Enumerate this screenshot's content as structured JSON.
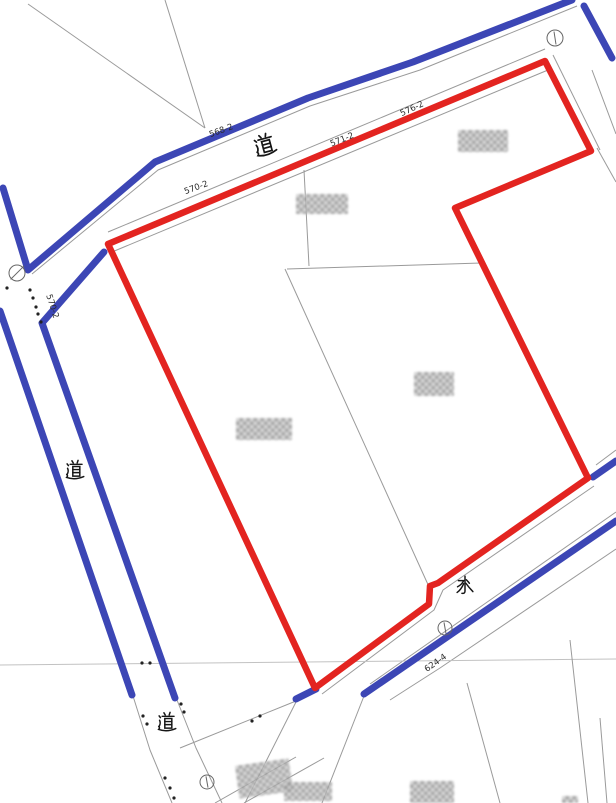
{
  "map": {
    "width": 616,
    "height": 803,
    "colors": {
      "road_water_highlight": "#3c46b5",
      "parcel_boundary": "#e32420",
      "thin_line": "#9a9a9a",
      "faint_line": "#c2c2c2",
      "text": "#2a2a2a",
      "background": "#ffffff"
    },
    "blue_lines": [
      {
        "name": "top-road-north-edge",
        "points": [
          [
            572,
            0
          ],
          [
            413,
            62
          ],
          [
            308,
            98
          ],
          [
            155,
            162
          ],
          [
            28,
            270
          ],
          [
            3,
            188
          ]
        ]
      },
      {
        "name": "northeast-channel",
        "points": [
          [
            584,
            6
          ],
          [
            612,
            58
          ]
        ]
      },
      {
        "name": "left-road-west-edge",
        "points": [
          [
            0,
            311
          ],
          [
            132,
            695
          ]
        ]
      },
      {
        "name": "left-road-east-edge",
        "points": [
          [
            104,
            252
          ],
          [
            42,
            323
          ],
          [
            175,
            698
          ]
        ]
      },
      {
        "name": "water-upper-right",
        "points": [
          [
            616,
            461
          ],
          [
            593,
            477
          ]
        ]
      },
      {
        "name": "water-lower-edge",
        "points": [
          [
            616,
            521
          ],
          [
            364,
            694
          ]
        ]
      },
      {
        "name": "water-bottom-short",
        "points": [
          [
            296,
            699
          ],
          [
            316,
            689
          ]
        ]
      }
    ],
    "red_lines": [
      {
        "name": "subject-parcel-boundary",
        "points": [
          [
            108,
            244
          ],
          [
            545,
            61
          ],
          [
            591,
            151
          ],
          [
            455,
            208
          ],
          [
            588,
            478
          ],
          [
            438,
            583
          ],
          [
            430,
            586
          ],
          [
            429,
            604
          ],
          [
            315,
            688
          ],
          [
            108,
            244
          ]
        ]
      }
    ],
    "thin_lines": [
      {
        "points": [
          [
            28,
            4
          ],
          [
            205,
            128
          ]
        ]
      },
      {
        "points": [
          [
            165,
            0
          ],
          [
            205,
            128
          ]
        ]
      },
      {
        "points": [
          [
            577,
            6
          ],
          [
            420,
            70
          ],
          [
            310,
            106
          ],
          [
            158,
            170
          ],
          [
            32,
            274
          ]
        ]
      },
      {
        "points": [
          [
            108,
            232
          ],
          [
            545,
            49
          ]
        ]
      },
      {
        "points": [
          [
            112,
            252
          ],
          [
            548,
            70
          ]
        ]
      },
      {
        "points": [
          [
            553,
            55
          ],
          [
            600,
            150
          ]
        ]
      },
      {
        "points": [
          [
            597,
            148
          ],
          [
            616,
            182
          ]
        ]
      },
      {
        "points": [
          [
            592,
            70
          ],
          [
            616,
            134
          ]
        ]
      },
      {
        "points": [
          [
            304,
            170
          ],
          [
            309,
            266
          ]
        ]
      },
      {
        "points": [
          [
            287,
            269
          ],
          [
            481,
            263
          ]
        ]
      },
      {
        "points": [
          [
            285,
            269
          ],
          [
            430,
            589
          ]
        ]
      },
      {
        "points": [
          [
            594,
            486
          ],
          [
            443,
            590
          ],
          [
            434,
            610
          ],
          [
            322,
            694
          ]
        ]
      },
      {
        "points": [
          [
            616,
            512
          ],
          [
            370,
            684
          ]
        ]
      },
      {
        "points": [
          [
            616,
            549
          ],
          [
            440,
            668
          ],
          [
            390,
            700
          ]
        ]
      },
      {
        "points": [
          [
            297,
            700
          ],
          [
            245,
            803
          ]
        ]
      },
      {
        "points": [
          [
            364,
            696
          ],
          [
            322,
            803
          ]
        ]
      },
      {
        "points": [
          [
            0,
            665
          ],
          [
            616,
            659
          ]
        ],
        "faint": true
      },
      {
        "points": [
          [
            467,
            683
          ],
          [
            500,
            803
          ]
        ]
      },
      {
        "points": [
          [
            570,
            640
          ],
          [
            588,
            803
          ]
        ]
      },
      {
        "points": [
          [
            600,
            718
          ],
          [
            607,
            803
          ]
        ]
      },
      {
        "points": [
          [
            133,
            696
          ],
          [
            150,
            750
          ],
          [
            172,
            803
          ]
        ]
      },
      {
        "points": [
          [
            177,
            700
          ],
          [
            196,
            748
          ],
          [
            222,
            803
          ]
        ]
      },
      {
        "points": [
          [
            180,
            748
          ],
          [
            296,
            701
          ]
        ]
      },
      {
        "points": [
          [
            215,
            803
          ],
          [
            296,
            757
          ]
        ]
      },
      {
        "points": [
          [
            244,
            803
          ],
          [
            324,
            758
          ]
        ]
      },
      {
        "points": [
          [
            616,
            450
          ],
          [
            596,
            465
          ]
        ]
      }
    ],
    "dots": [
      [
        7,
        288
      ],
      [
        30,
        290
      ],
      [
        33,
        298
      ],
      [
        36,
        307
      ],
      [
        38,
        314
      ],
      [
        41,
        322
      ],
      [
        142,
        663
      ],
      [
        150,
        663
      ],
      [
        181,
        704
      ],
      [
        184,
        712
      ],
      [
        143,
        716
      ],
      [
        147,
        724
      ],
      [
        165,
        778
      ],
      [
        170,
        788
      ],
      [
        174,
        798
      ],
      [
        252,
        721
      ],
      [
        260,
        716
      ]
    ],
    "survey_circles": [
      {
        "name": "survey-marker-top-right",
        "x": 555,
        "y": 38,
        "r": 8,
        "mark": "bar"
      },
      {
        "name": "survey-marker-left",
        "x": 17,
        "y": 273,
        "r": 8,
        "mark": "slash"
      },
      {
        "name": "survey-marker-water",
        "x": 445,
        "y": 628,
        "r": 7,
        "mark": "bar"
      },
      {
        "name": "survey-marker-bottom",
        "x": 207,
        "y": 782,
        "r": 7,
        "mark": "bar"
      }
    ],
    "lot_labels": [
      {
        "text": "568-2",
        "x": 222,
        "y": 133,
        "rot": -20
      },
      {
        "text": "571-2",
        "x": 343,
        "y": 142,
        "rot": -22
      },
      {
        "text": "576-2",
        "x": 413,
        "y": 111,
        "rot": -25
      },
      {
        "text": "570-2",
        "x": 197,
        "y": 190,
        "rot": -20
      },
      {
        "text": "570-2",
        "x": 50,
        "y": 307,
        "rot": 72
      },
      {
        "text": "624-4",
        "x": 437,
        "y": 665,
        "rot": -35
      }
    ],
    "kanji_labels": [
      {
        "char": "道",
        "meaning": "road",
        "name": "road-kanji-top",
        "x": 265,
        "y": 145,
        "size": 24,
        "rot": -15
      },
      {
        "char": "道",
        "meaning": "road",
        "name": "road-kanji-left",
        "x": 75,
        "y": 470,
        "size": 21,
        "rot": 0
      },
      {
        "char": "道",
        "meaning": "road",
        "name": "road-kanji-bottom",
        "x": 167,
        "y": 722,
        "size": 21,
        "rot": 0
      },
      {
        "char": "水",
        "meaning": "water",
        "name": "water-kanji",
        "x": 465,
        "y": 585,
        "size": 21,
        "rot": 0
      }
    ],
    "blurred_parcel_numbers": [
      {
        "name": "blurred-parcel-number-ne",
        "x": 458,
        "y": 130,
        "w": 50,
        "h": 22,
        "rot": 0
      },
      {
        "name": "blurred-parcel-number-center-top",
        "x": 296,
        "y": 194,
        "w": 52,
        "h": 20,
        "rot": 0
      },
      {
        "name": "blurred-parcel-number-west",
        "x": 236,
        "y": 418,
        "w": 56,
        "h": 22,
        "rot": 0
      },
      {
        "name": "blurred-parcel-number-east",
        "x": 414,
        "y": 372,
        "w": 40,
        "h": 24,
        "rot": 0
      },
      {
        "name": "blurred-parcel-number-bottom-1",
        "x": 237,
        "y": 762,
        "w": 54,
        "h": 33,
        "rot": -8
      },
      {
        "name": "blurred-parcel-number-bottom-2",
        "x": 284,
        "y": 782,
        "w": 48,
        "h": 19,
        "rot": 0
      },
      {
        "name": "blurred-parcel-number-bottom-3",
        "x": 410,
        "y": 781,
        "w": 44,
        "h": 22,
        "rot": 0
      },
      {
        "name": "blurred-parcel-number-edge",
        "x": 562,
        "y": 796,
        "w": 16,
        "h": 7,
        "rot": 0
      }
    ]
  }
}
